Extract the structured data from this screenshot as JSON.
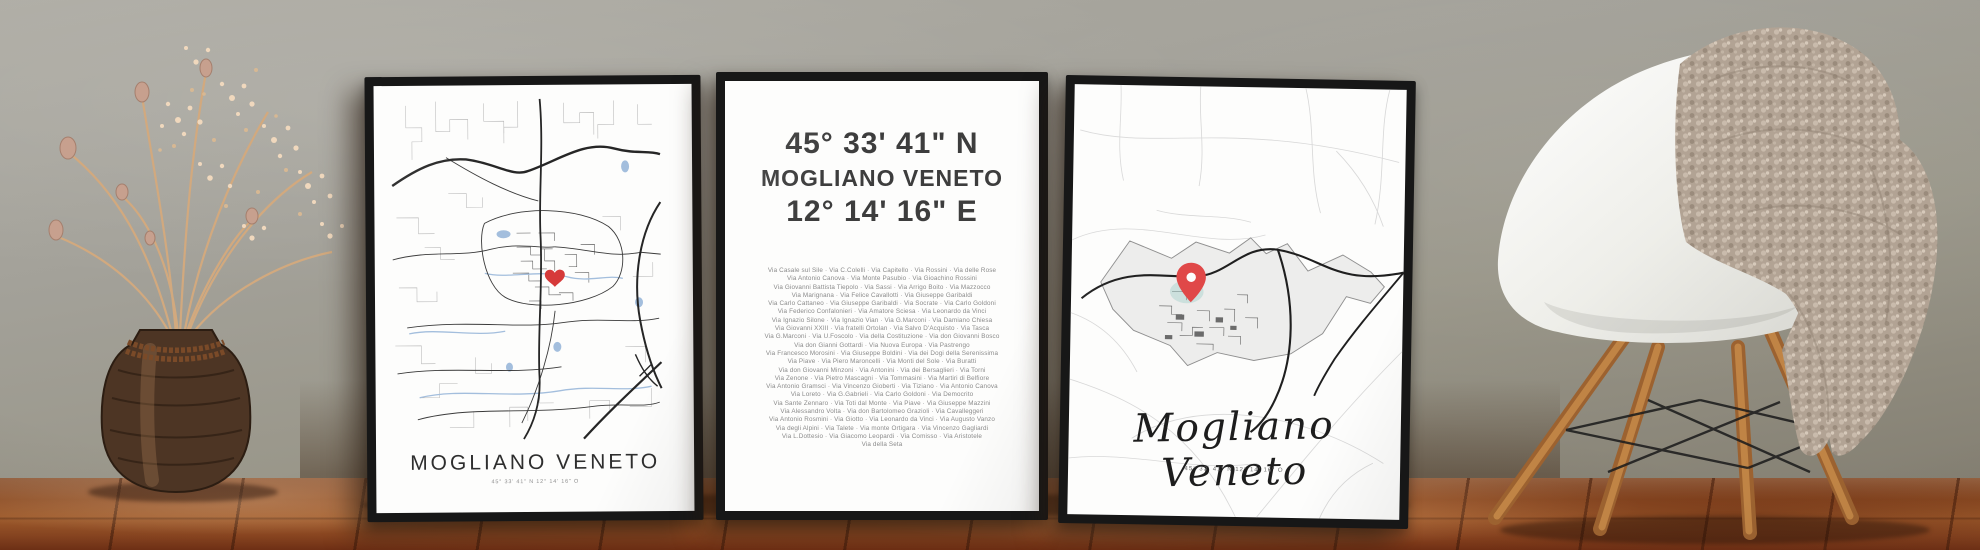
{
  "posters": {
    "left": {
      "title": "MOGLIANO VENETO",
      "subtitle": "45° 33' 41\" N 12° 14' 16\" O",
      "marker": "heart"
    },
    "middle": {
      "latitude": "45° 33' 41\" N",
      "city": "MOGLIANO VENETO",
      "longitude": "12° 14' 16\" E",
      "street_lines": [
        "Via Casale sul Sile · Via C.Colelli · Via Capitello · Via Rossini · Via delle Rose",
        "Via Antonio Canova · Via Monte Pasubio · Via Gioachino Rossini",
        "Via Giovanni Battista Tiepolo · Via Sassi · Via Arrigo Boito · Via Mazzocco",
        "Via Marignana · Via Felice Cavallotti · Via Giuseppe Garibaldi",
        "Via Carlo Cattaneo · Via Giuseppe Garibaldi · Via Socrate · Via Carlo Goldoni",
        "Via Federico Confalonieri · Via Amatore Sciesa · Via Leonardo da Vinci",
        "Via Ignazio Silone · Via Ignazio Vian · Via G.Marconi · Via Damiano Chiesa",
        "Via Giovanni XXIII · Via fratelli Ortolan · Via Salvo D'Acquisto · Via Tasca",
        "Via G.Marconi · Via U.Foscolo · Via della Costituzione · Via don Giovanni Bosco",
        "Via don Gianni Gottardi · Via Nuova Europa · Via Pastrengo",
        "Via Francesco Morosini · Via Giuseppe Boldini · Via dei Dogi della Serenissima",
        "Via Piave · Via Piero Maroncelli · Via Monti del Sole · Via Buratti",
        "Via don Giovanni Minzoni · Via Antonini · Via dei Bersaglieri · Via Torni",
        "Via Zenone · Via Pietro Mascagni · Via Tommasini · Via Martiri di Belfiore",
        "Via Antonio Gramsci · Via Vincenzo Gioberti · Via Tiziano · Via Antonio Canova",
        "Via Loreto · Via G.Gabrieli · Via Carlo Goldoni · Via Democrito",
        "Via Sante Zennaro · Via Toti dal Monte · Via Piave · Via Giuseppe Mazzini",
        "Via Alessandro Volta · Via don Bartolomeo Grazioli · Via Cavalleggeri",
        "Via Antonio Rosmini · Via Giotto · Via Leonardo da Vinci · Via Augusto Vanzo",
        "Via degli Alpini · Via Talete · Via monte Ortigara · Via Vincenzo Gagliardi",
        "Via L.Dottesio · Via Giacomo Leopardi · Via Comisso · Via Aristotele",
        "Via della Seta"
      ]
    },
    "right": {
      "title": "Mogliano Veneto",
      "subtitle": "45° 33' 41\" N 12° 14' 16\" O",
      "marker": "pin"
    }
  },
  "colors": {
    "frame": "#171717",
    "heart_marker": "#d63a3a",
    "pin_marker": "#e04848",
    "map_road_dark": "#2e2e2e",
    "map_water": "#a3bedd",
    "wall": "#a3a199",
    "floor_wood": "#8c4a22",
    "chair_shell": "#f4f3ef",
    "chair_legs": "#b37a41",
    "blanket": "#b2a394"
  }
}
